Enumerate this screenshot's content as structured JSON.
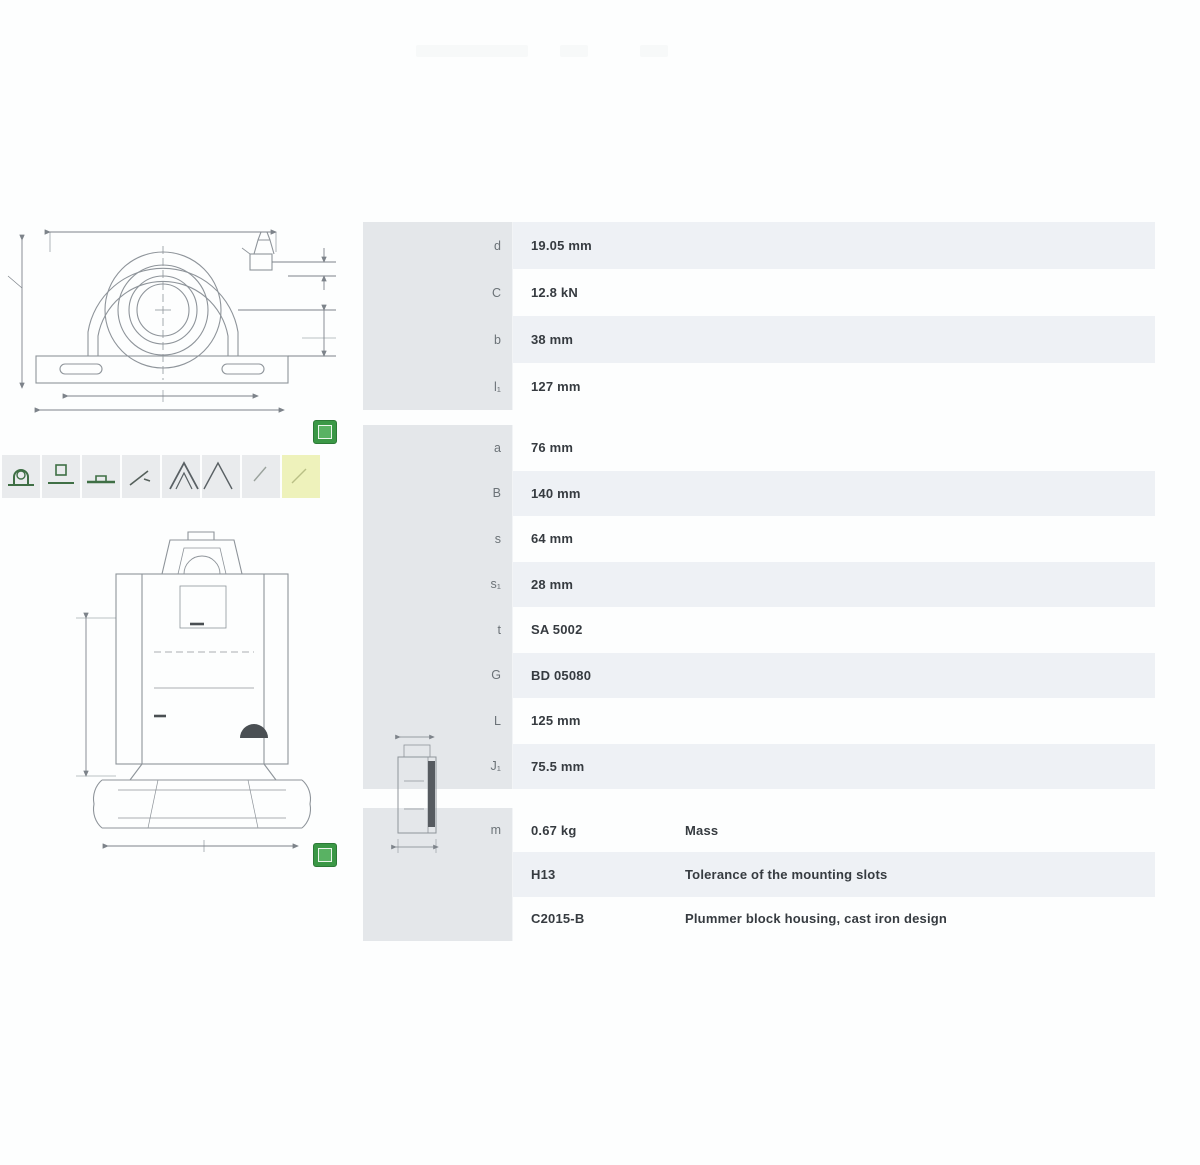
{
  "colors": {
    "accent_green": "#3b9846",
    "row_stripe": "#eef1f5",
    "sidebar_gray": "#e4e7ea",
    "selected_thumbnail": "#eef2bb"
  },
  "gallery": {
    "thumbnails": [
      {
        "name": "unit-front-view"
      },
      {
        "name": "unit-side-view"
      },
      {
        "name": "unit-base-view"
      },
      {
        "name": "unit-sketch-view"
      },
      {
        "name": "unit-angle-view"
      },
      {
        "name": "unit-roof-view"
      },
      {
        "name": "unit-light-view"
      },
      {
        "name": "unit-selected-view"
      }
    ]
  },
  "product_table": {
    "sections": [
      {
        "rows": [
          {
            "label": "d",
            "value": "19.05 mm"
          },
          {
            "label": "C",
            "value": "12.8 kN"
          },
          {
            "label": "b",
            "value": "38 mm"
          },
          {
            "label": "l₁",
            "value": "127 mm"
          }
        ]
      },
      {
        "rows": [
          {
            "label": "a",
            "value": "76 mm"
          },
          {
            "label": "B",
            "value": "140 mm"
          },
          {
            "label": "s",
            "value": "64 mm"
          },
          {
            "label": "s₁",
            "value": "28 mm"
          },
          {
            "label": "t",
            "value": "SA 5002"
          },
          {
            "label": "G",
            "value": "BD 05080"
          },
          {
            "label": "L",
            "value": "125 mm"
          },
          {
            "label": "J₁",
            "value": "75.5 mm"
          }
        ]
      },
      {
        "rows": [
          {
            "label": "m",
            "value": "0.67 kg",
            "desc": "Mass"
          },
          {
            "label": "",
            "value": "H13",
            "desc": "Tolerance of the mounting slots"
          },
          {
            "label": "",
            "value": "C2015-B",
            "desc": "Plummer block housing, cast iron design"
          }
        ]
      }
    ]
  }
}
